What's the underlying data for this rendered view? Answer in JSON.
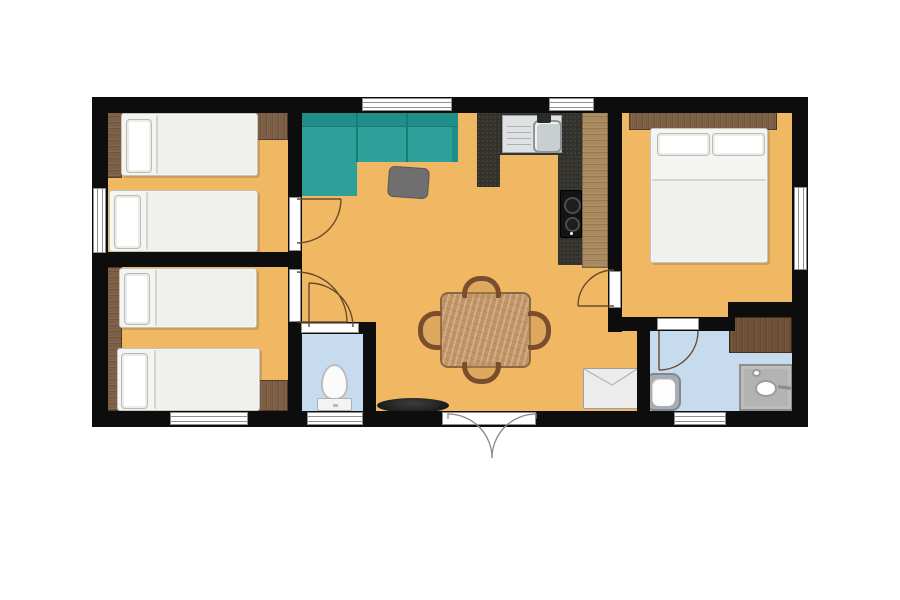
{
  "plan": {
    "type": "floor-plan",
    "description": "small holiday home / mobile home floor plan, top-down view, no text labels",
    "rooms": [
      {
        "id": "bedroom-1",
        "position": "top-left",
        "furniture": [
          "closet-strip",
          "single-bed",
          "single-bed",
          "corner-shelf"
        ],
        "windows": [
          "left-wall"
        ]
      },
      {
        "id": "bedroom-2",
        "position": "bottom-left",
        "furniture": [
          "closet-strip",
          "single-bed",
          "single-bed",
          "corner-desk"
        ],
        "windows": [
          "bottom-wall"
        ]
      },
      {
        "id": "living-dining",
        "position": "center",
        "furniture": [
          "corner-sofa",
          "pouf",
          "dining-table",
          "chair",
          "chair",
          "chair",
          "chair",
          "tv",
          "fridge"
        ],
        "windows": [
          "top-wall"
        ]
      },
      {
        "id": "kitchen",
        "position": "center-right",
        "furniture": [
          "counter-with-sink",
          "two-burner-hob",
          "cabinet-run"
        ],
        "windows": [
          "top-wall"
        ]
      },
      {
        "id": "bedroom-3",
        "position": "right",
        "furniture": [
          "headboard-shelf",
          "double-bed"
        ],
        "windows": [
          "right-wall"
        ]
      },
      {
        "id": "wc",
        "position": "bottom-center",
        "furniture": [
          "toilet"
        ],
        "windows": [
          "bottom-wall"
        ]
      },
      {
        "id": "bathroom",
        "position": "bottom-right",
        "furniture": [
          "washbasin",
          "shower",
          "wardrobe-cabinet"
        ],
        "windows": [
          "bottom-wall"
        ]
      }
    ],
    "doors": {
      "entrance": "double-french-door-bottom-center",
      "interior_doors": [
        "bedroom-1",
        "bedroom-2",
        "bedroom-3",
        "wc",
        "bathroom"
      ]
    },
    "window_count": {
      "top": 2,
      "bottom": 3,
      "left": 1,
      "right": 1
    }
  },
  "palette": {
    "background": "#ffffff",
    "wall": "#0d0d0d",
    "floor": "#f0b863",
    "wet_floor": "#c7dbee",
    "sofa": "#2da199",
    "sofa_back": "#1f8e88",
    "sofa_seam": "#157d77",
    "wood_light": "#a98a5f",
    "wood_mid": "#7c5f45",
    "wood_dark": "#6e5137",
    "counter": "#33312b",
    "table_wood": "#c29365",
    "chair_wood": "#7a4e2d",
    "bed": "#f4f4f3",
    "bed_border": "#c7c3ba",
    "pouf": "#6f6f6f",
    "appliance": "#ececec",
    "frame": "#8f8f8f",
    "door_arc": "#6b4a2a",
    "entry_arc": "#8a8a8a"
  }
}
